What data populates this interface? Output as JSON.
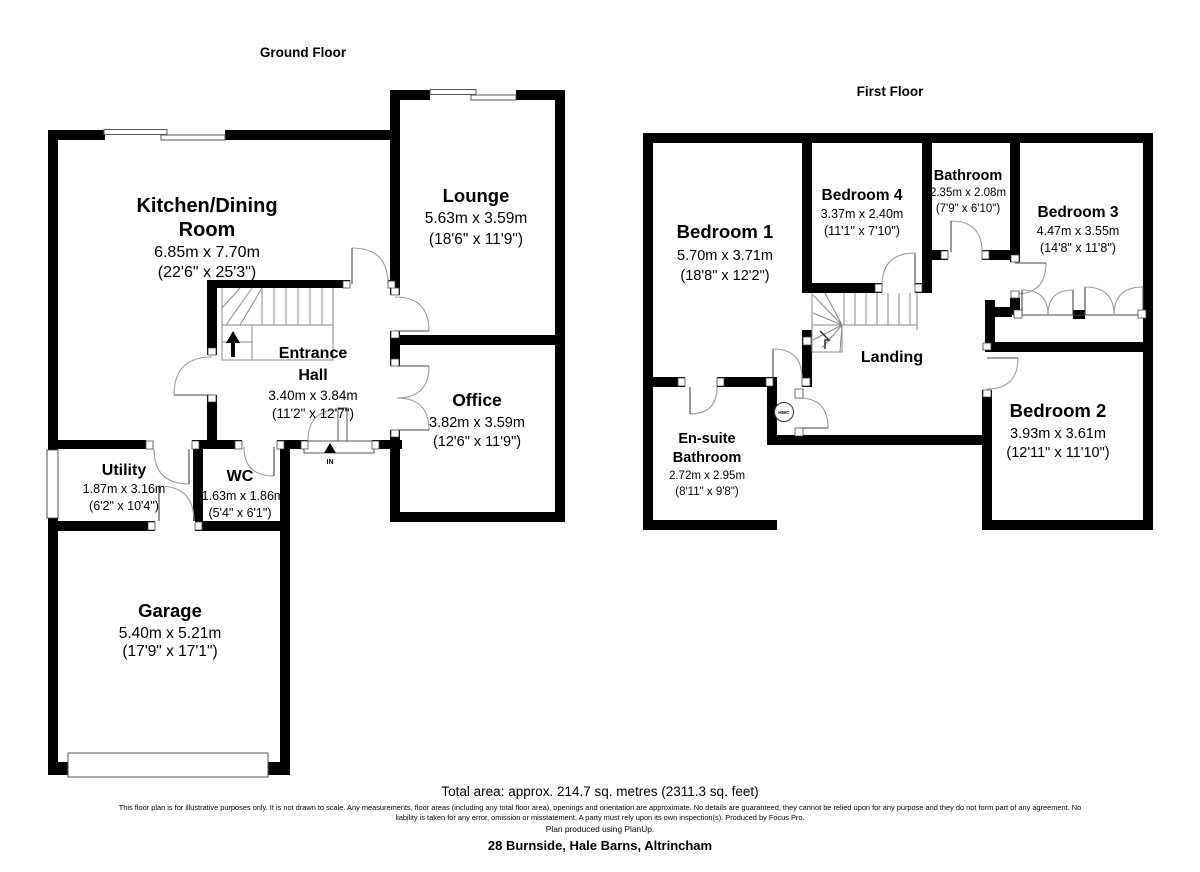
{
  "colors": {
    "walls": "#000000",
    "background": "#ffffff",
    "door_swing": "#9a9a9a"
  },
  "ground": {
    "title": "Ground Floor",
    "kitchen": {
      "lines": [
        "Kitchen/Dining",
        "Room"
      ],
      "metric": "6.85m x 7.70m",
      "imperial": "(22'6\" x 25'3\")"
    },
    "lounge": {
      "lines": [
        "Lounge"
      ],
      "metric": "5.63m x 3.59m",
      "imperial": "(18'6\" x 11'9\")"
    },
    "hall": {
      "lines": [
        "Entrance",
        "Hall"
      ],
      "metric": "3.40m x 3.84m",
      "imperial": "(11'2\" x 12'7\")"
    },
    "office": {
      "lines": [
        "Office"
      ],
      "metric": "3.82m x 3.59m",
      "imperial": "(12'6\" x 11'9\")"
    },
    "wc": {
      "lines": [
        "WC"
      ],
      "metric": "1.63m x 1.86m",
      "imperial": "(5'4\" x 6'1\")"
    },
    "utility": {
      "lines": [
        "Utility"
      ],
      "metric": "1.87m x 3.16m",
      "imperial": "(6'2\" x 10'4\")"
    },
    "garage": {
      "lines": [
        "Garage"
      ],
      "metric": "5.40m x 5.21m",
      "imperial": "(17'9\" x 17'1\")"
    },
    "entrance_label": "IN"
  },
  "first": {
    "title": "First Floor",
    "bedroom1": {
      "lines": [
        "Bedroom 1"
      ],
      "metric": "5.70m x 3.71m",
      "imperial": "(18'8\" x 12'2\")"
    },
    "bedroom4": {
      "lines": [
        "Bedroom 4"
      ],
      "metric": "3.37m x 2.40m",
      "imperial": "(11'1\" x 7'10\")"
    },
    "bathroom": {
      "lines": [
        "Bathroom"
      ],
      "metric": "2.35m x 2.08m",
      "imperial": "(7'9\" x 6'10\")"
    },
    "bedroom3": {
      "lines": [
        "Bedroom 3"
      ],
      "metric": "4.47m x 3.55m",
      "imperial": "(14'8\" x 11'8\")"
    },
    "landing": {
      "lines": [
        "Landing"
      ]
    },
    "ensuite": {
      "lines": [
        "En-suite",
        "Bathroom"
      ],
      "metric": "2.72m x 2.95m",
      "imperial": "(8'11\" x 9'8\")"
    },
    "bedroom2": {
      "lines": [
        "Bedroom 2"
      ],
      "metric": "3.93m x 3.61m",
      "imperial": "(12'11\" x 11'10\")"
    },
    "hwc_label": "HWC"
  },
  "footer": {
    "total_area": "Total area: approx. 214.7 sq. metres (2311.3 sq. feet)",
    "disclaimer": "This floor plan is for illustrative purposes only. It is not drawn to scale. Any measurements, floor areas (including any total floor area), openings and orientation are approximate. No details are guaranteed, they cannot be relied upon for any purpose and they do not form part of any agreement. No liability is taken for any error, omission or misstatement. A party must rely upon its own inspection(s). Produced by Focus Pro.",
    "software_credit": "Plan produced using PlanUp.",
    "address": "28 Burnside, Hale Barns, Altrincham"
  }
}
